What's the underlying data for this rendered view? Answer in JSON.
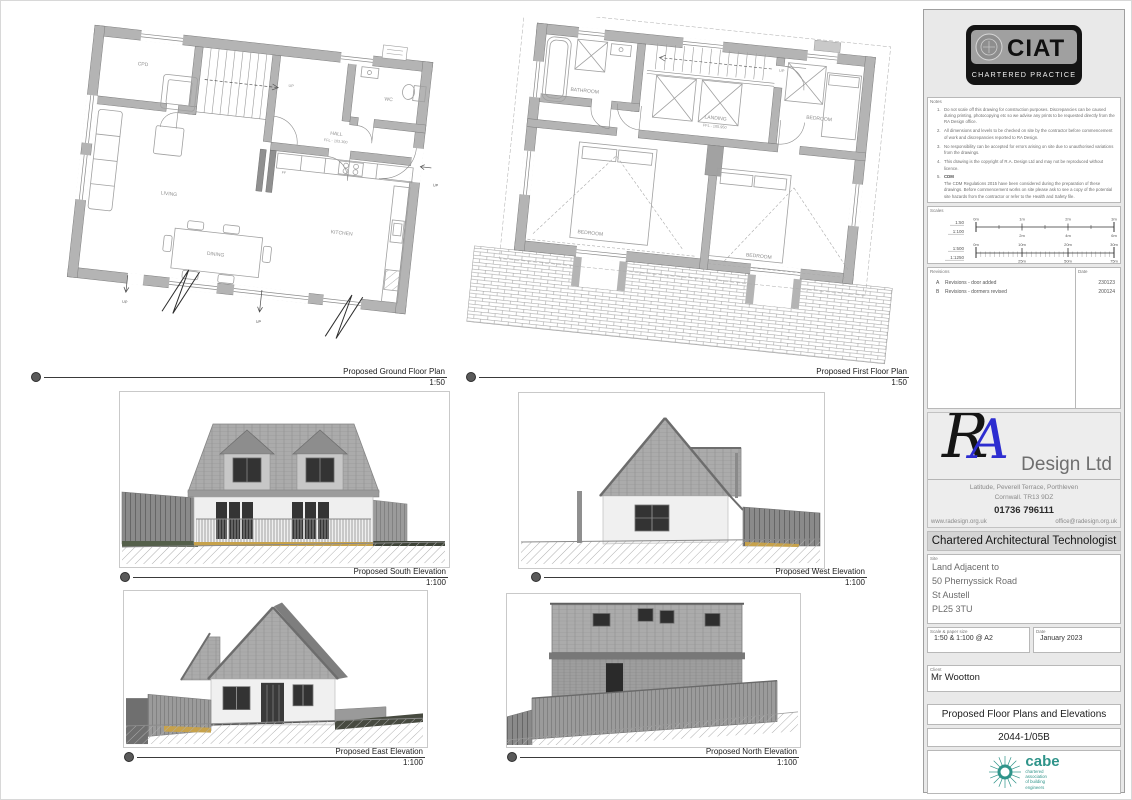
{
  "sheet": {
    "ground_plan": {
      "caption": "Proposed Ground Floor Plan",
      "scale": "1:50",
      "rooms": {
        "cpd": "CPD",
        "wc": "WC",
        "hall": "HALL",
        "hall_level": "FFL - 103.300",
        "living": "LIVING",
        "kitchen": "KITCHEN",
        "dining": "DINING",
        "ff": "FF"
      },
      "up1": "UP",
      "up2": "UP",
      "up3": "UP",
      "up4": "UP"
    },
    "first_plan": {
      "caption": "Proposed First Floor Plan",
      "scale": "1:50",
      "rooms": {
        "bathroom": "BATHROOM",
        "landing": "LANDING",
        "landing_level": "FFL - 105.950",
        "bedroom1": "BEDROOM",
        "bedroom2": "BEDROOM",
        "bedroom3": "BEDROOM"
      },
      "up": "UP"
    },
    "elevations": {
      "south": {
        "caption": "Proposed South Elevation",
        "scale": "1:100"
      },
      "west": {
        "caption": "Proposed West Elevation",
        "scale": "1:100"
      },
      "east": {
        "caption": "Proposed East Elevation",
        "scale": "1:100"
      },
      "north": {
        "caption": "Proposed North Elevation",
        "scale": "1:100"
      }
    }
  },
  "titleblock": {
    "ciat": {
      "acronym": "CIAT",
      "subtitle": "CHARTERED PRACTICE"
    },
    "notes": {
      "label": "Notes",
      "items": [
        {
          "n": "1.",
          "text": "Do not scale off this drawing for construction purposes. Discrepancies can be caused during printing, photocopying etc so we advise any prints to be requested directly from the RA Design office."
        },
        {
          "n": "2.",
          "text": "All dimensions and levels to be checked on site by the contractor before commencement of work and discrepancies reported to RA Design."
        },
        {
          "n": "3.",
          "text": "No responsibility can be accepted for errors arising on site due to unauthorised variations from the drawings."
        },
        {
          "n": "4.",
          "text": "This drawing is the copyright of R.A. Design Ltd and may not be reproduced without licence."
        },
        {
          "n": "5.",
          "heading": "CDM",
          "text": "The CDM Regulations 2015 have been considered during the preparation of these drawings. Before commencement works on site please ask to see a copy of the potential site hazards from the contractor or refer to the Health and Safety file."
        }
      ]
    },
    "scales": {
      "label": "Scales",
      "bar1": {
        "left1": "1:50",
        "left2": "1:100",
        "top": [
          "0m",
          "1m",
          "2m",
          "3m"
        ],
        "bottom": [
          "2m",
          "4m",
          "6m"
        ]
      },
      "bar2": {
        "left1": "1:500",
        "left2": "1:1250",
        "top": [
          "0m",
          "10m",
          "20m",
          "30m"
        ],
        "bottom": [
          "25m",
          "50m",
          "75m"
        ]
      }
    },
    "revisions": {
      "label": "Revisions",
      "date_label": "Date",
      "rows": [
        {
          "rev": "A",
          "desc": "Revisions - door added",
          "date": "230123"
        },
        {
          "rev": "B",
          "desc": "Revisions - dormers revised",
          "date": "200124"
        }
      ]
    },
    "brand": {
      "monogram_r": "R",
      "monogram_a": "A",
      "company": "Design Ltd",
      "address_line1": "Latitude, Peverell Terrace, Porthleven",
      "address_line2": "Cornwall. TR13 9DZ",
      "phone": "01736 796111",
      "website": "www.radesign.org.uk",
      "email": "office@radesign.org.uk",
      "strapline": "Chartered Architectural  Technologist",
      "accent_blue": "#2d2dd0"
    },
    "site": {
      "label": "Site",
      "lines": [
        "Land Adjacent to",
        "50 Phernyssick Road",
        "St Austell",
        "PL25 3TU"
      ]
    },
    "scale_paper": {
      "label": "Scale & paper size",
      "value": "1:50 & 1:100 @ A2"
    },
    "date": {
      "label": "Date",
      "value": "January 2023"
    },
    "client": {
      "label": "Client",
      "value": "Mr Wootton"
    },
    "drawing_title": "Proposed Floor Plans and Elevations",
    "drawing_number": "2044-1/05B",
    "cabe": {
      "name": "cabe",
      "desc_lines": [
        "chartered",
        "association",
        "of building",
        "engineers"
      ],
      "color": "#2f948a"
    }
  }
}
